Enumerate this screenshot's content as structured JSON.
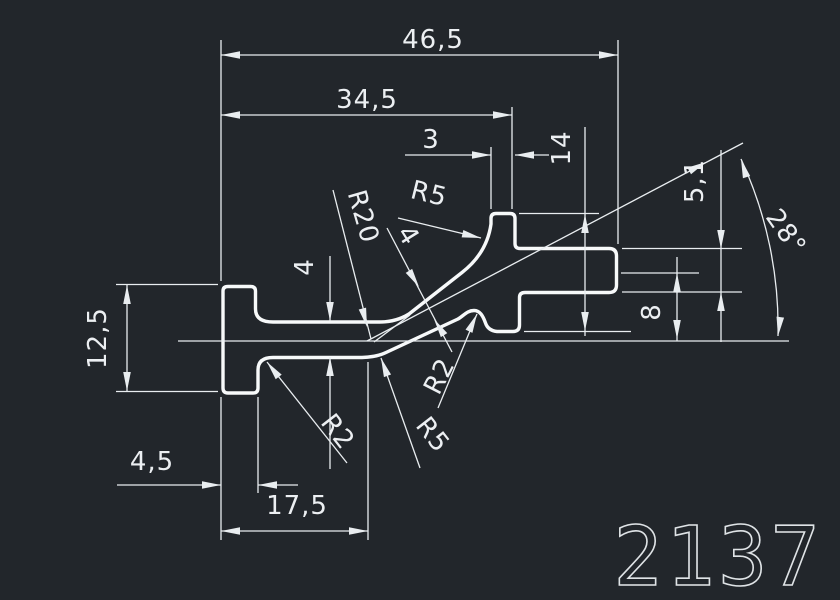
{
  "part_number": "2137",
  "colors": {
    "background": "#22262b",
    "profile_line": "#f7f9fa",
    "dim_line": "#e9edf0",
    "text": "#eceff2"
  },
  "dimensions": {
    "total_width": "46,5",
    "upper_width": "34,5",
    "step_width": "3",
    "step_depth": "14",
    "arm_thickness": "5,1",
    "angle": "28°",
    "slot_offset": "8",
    "foot_height": "12,5",
    "web_thickness_left": "4",
    "web_thickness_incline": "4",
    "foot_width": "4,5",
    "bottom_length": "17,5"
  },
  "radii": {
    "r20": "R20",
    "r5_top": "R5",
    "r2_foot": "R2",
    "r5_bottom": "R5",
    "r2_bump": "R2"
  }
}
